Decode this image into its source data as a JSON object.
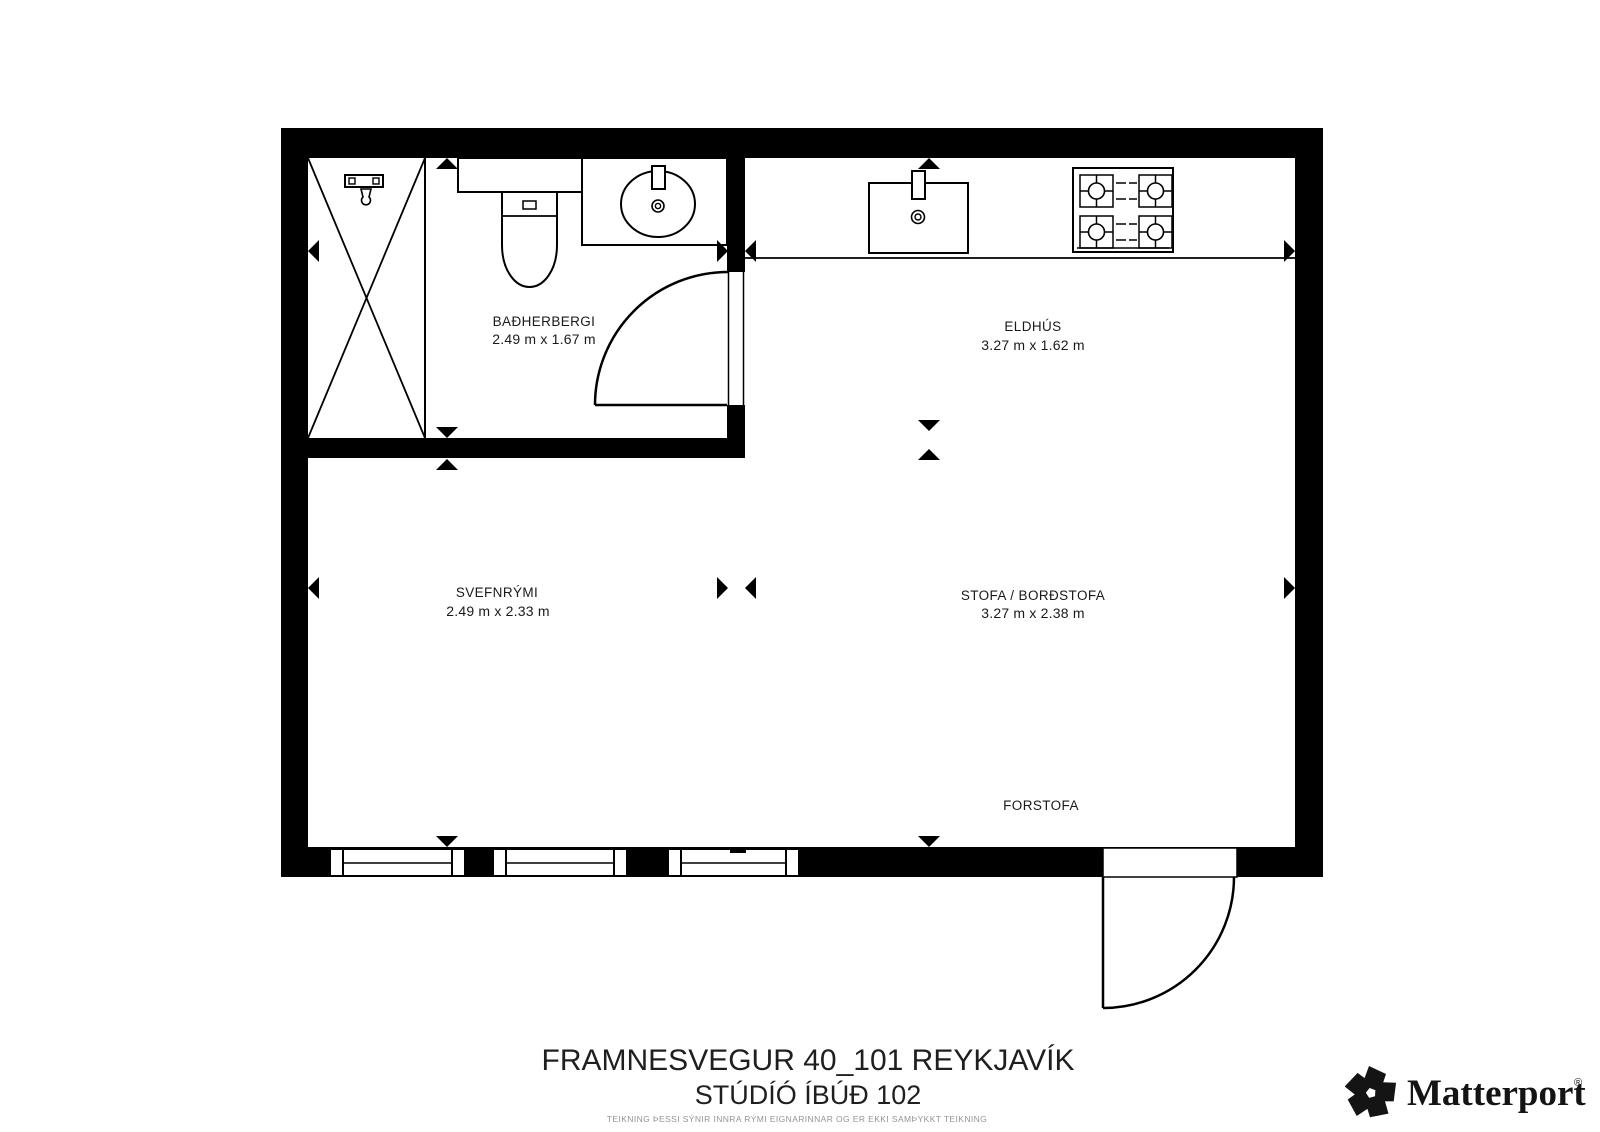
{
  "colors": {
    "ink": "#000000",
    "label_text": "#1a1a1a",
    "muted_text": "#949494",
    "background": "#ffffff"
  },
  "rooms": [
    {
      "id": "badherbergi",
      "name": "BAÐHERBERGI",
      "dimensions": "2.49 m x 1.67 m"
    },
    {
      "id": "eldhus",
      "name": "ELDHÚS",
      "dimensions": "3.27 m x 1.62 m"
    },
    {
      "id": "svefnrymi",
      "name": "SVEFNRÝMI",
      "dimensions": "2.49 m x 2.33 m"
    },
    {
      "id": "stofa_bordstofa",
      "name": "STOFA / BORÐSTOFA",
      "dimensions": "3.27 m x 2.38 m"
    },
    {
      "id": "forstofa",
      "name": "FORSTOFA",
      "dimensions": ""
    }
  ],
  "title_block": {
    "address": "FRAMNESVEGUR 40_101 REYKJAVÍK",
    "unit": "STÚDÍÓ ÍBÚÐ 102",
    "disclaimer": "TEIKNING ÞESSI SÝNIR INNRA RÝMI EIGNARINNAR OG ER EKKI SAMÞYKKT TEIKNING"
  },
  "branding": {
    "wordmark": "Matterport",
    "registered_mark": "®"
  },
  "icons": [
    "shower-icon",
    "toilet-icon",
    "bathroom-sink-icon",
    "kitchen-sink-icon",
    "stove-icon",
    "door-swing-icon",
    "window-icon",
    "measurement-arrow-icon",
    "matterport-logo-icon"
  ]
}
